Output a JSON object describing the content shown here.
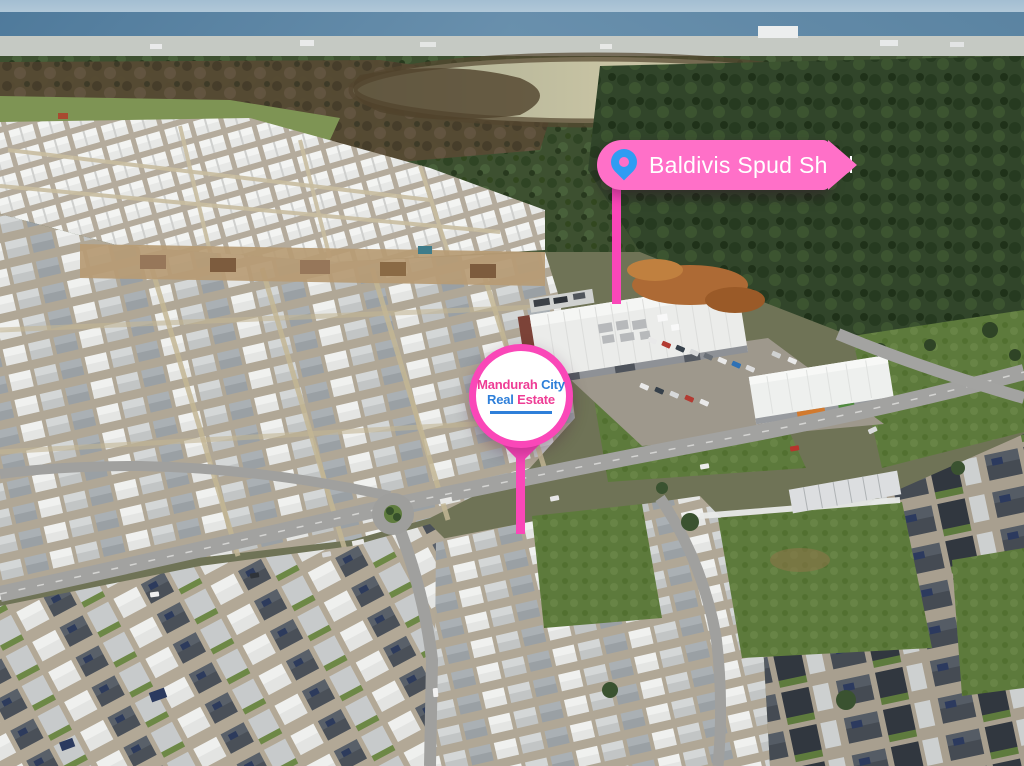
{
  "markers": {
    "spud_shed": {
      "label": "Baldivis Spud Shed"
    },
    "agency_logo": {
      "name_line1_part1": "Mandurah",
      "name_line1_part2": "City",
      "name_line2_part1": "Real",
      "name_line2_part2": "Estate"
    }
  },
  "colors": {
    "banner-pink": "#ff70c8",
    "marker-pink": "#fa47b8",
    "pin-blue": "#2f9cf3",
    "logo-pink": "#ee3d95",
    "logo-blue": "#2e7fd9",
    "banner-text": "#ffffff"
  }
}
